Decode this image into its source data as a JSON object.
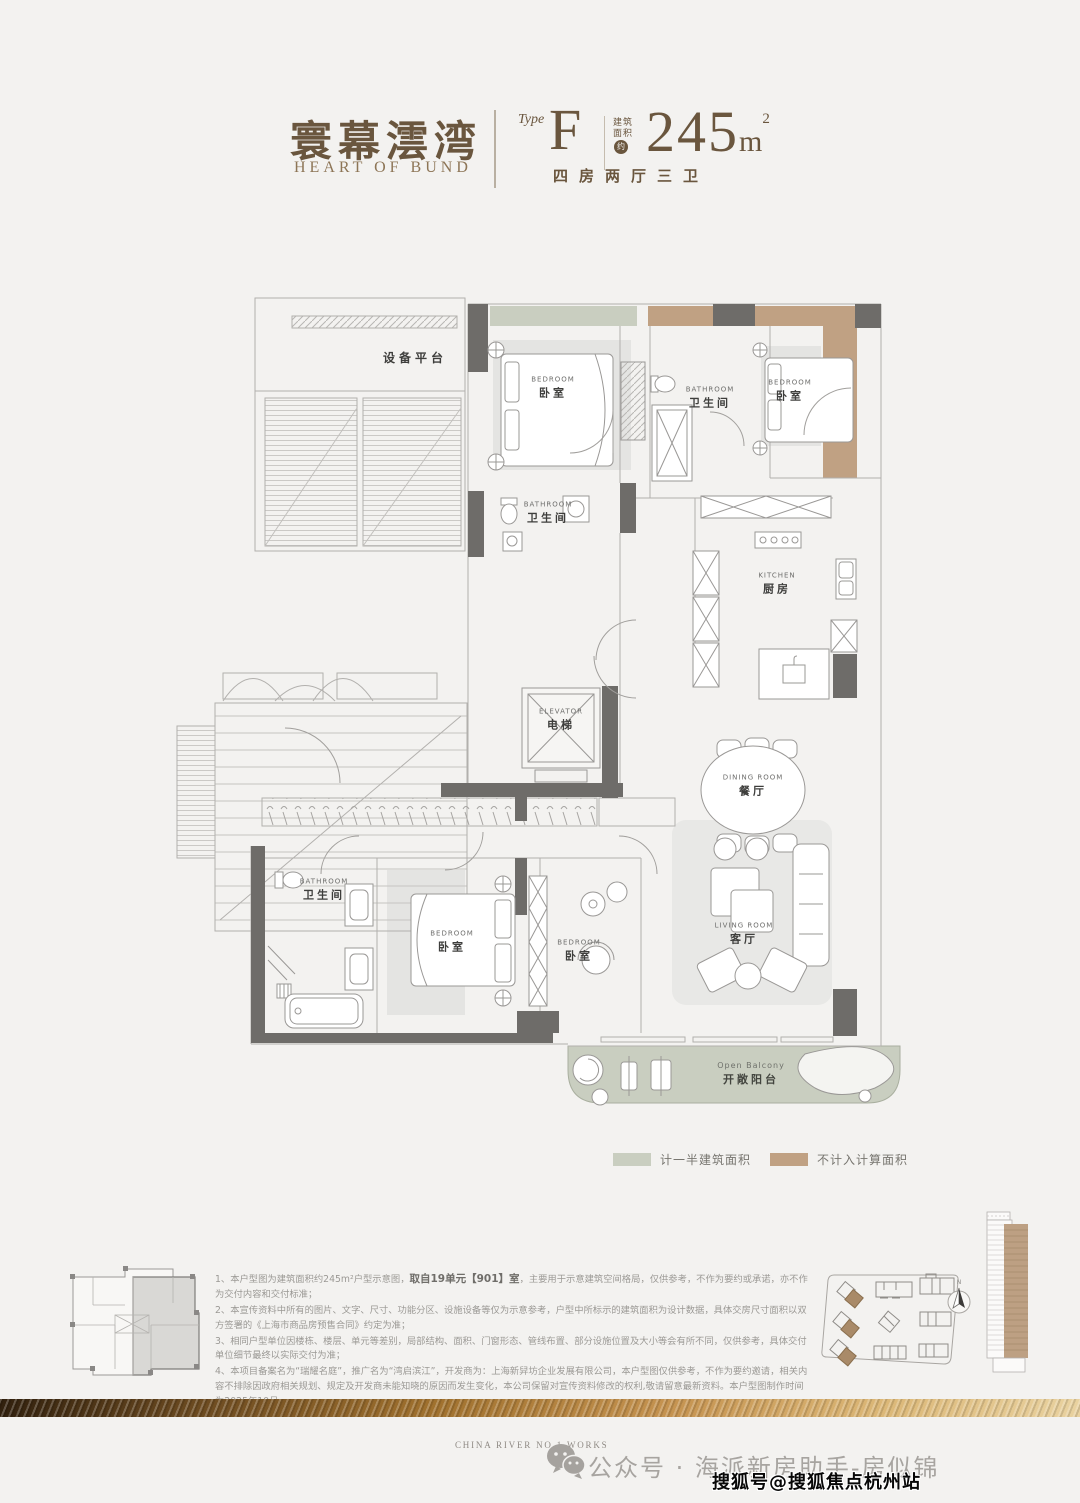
{
  "header": {
    "brand_cn": "寰幕澐湾",
    "brand_en": "HEART OF BUND",
    "type_label": "Type",
    "type_value": "F",
    "area_label_1": "建筑",
    "area_label_2": "面积",
    "area_badge": "约",
    "area_value": "245",
    "area_unit": "m",
    "area_sup": "2",
    "layout_text": "四房两厅三卫"
  },
  "plan": {
    "rooms": {
      "equipment": {
        "cn": "设备平台"
      },
      "bedroom_top_left": {
        "en": "BEDROOM",
        "cn": "卧室"
      },
      "bathroom_top": {
        "en": "BATHROOM",
        "cn": "卫生间"
      },
      "bedroom_top_right": {
        "en": "BEDROOM",
        "cn": "卧室"
      },
      "bathroom_mid": {
        "en": "BATHROOM",
        "cn": "卫生间"
      },
      "kitchen": {
        "en": "KITCHEN",
        "cn": "厨房"
      },
      "elevator": {
        "en": "ELEVATOR",
        "cn": "电梯"
      },
      "dining": {
        "en": "DINING ROOM",
        "cn": "餐厅"
      },
      "living": {
        "en": "LIVING ROOM",
        "cn": "客厅"
      },
      "bathroom_bottom": {
        "en": "BATHROOM",
        "cn": "卫生间"
      },
      "bedroom_master": {
        "en": "BEDROOM",
        "cn": "卧室"
      },
      "bedroom_small": {
        "en": "BEDROOM",
        "cn": "卧室"
      },
      "balcony": {
        "en": "Open Balcony",
        "cn": "开敞阳台"
      }
    }
  },
  "legend": {
    "half_area": {
      "label": "计一半建筑面积",
      "color": "#c9cec0"
    },
    "excluded": {
      "label": "不计入计算面积",
      "color": "#c0a183"
    }
  },
  "notes": {
    "line1_pre": "1、本户型图为建筑面积约245m²户型示意图，",
    "line1_bold": "取自19单元【901】室",
    "line1_post": "，主要用于示意建筑空间格局，仅供参考，不作为要约或承诺，亦不作为交付内容和交付标准；",
    "line2": "2、本宣传资料中所有的图片、文字、尺寸、功能分区、设施设备等仅为示意参考，户型中所标示的建筑面积为设计数据，具体交房尺寸面积以双方签署的《上海市商品房预售合同》约定为准；",
    "line3": "3、相同户型单位因楼栋、楼层、单元等差别，局部结构、面积、门窗形态、管线布置、部分设施位置及大小等会有所不同，仅供参考，具体交付单位细节最终以实际交付为准；",
    "line4": "4、本项目备案名为“瑞耀名庭”，推广名为“湾启滨江”，开发商为：上海新舁坊企业发展有限公司，本户型图仅供参考，不作为要约邀请，相关内容不排除因政府相关规划、规定及开发商未能知晓的原因而发生变化，本公司保留对宣传资料修改的权利,敬请留意最新资料。本户型图制作时间为2025年10月。"
  },
  "compass": {
    "label": "N"
  },
  "footer": {
    "works_text": "CHINA RIVER NO.1 WORKS",
    "account_text": "公众号 · 海派新房助手-房似锦",
    "watermark": "搜狐号@搜狐焦点杭州站"
  }
}
